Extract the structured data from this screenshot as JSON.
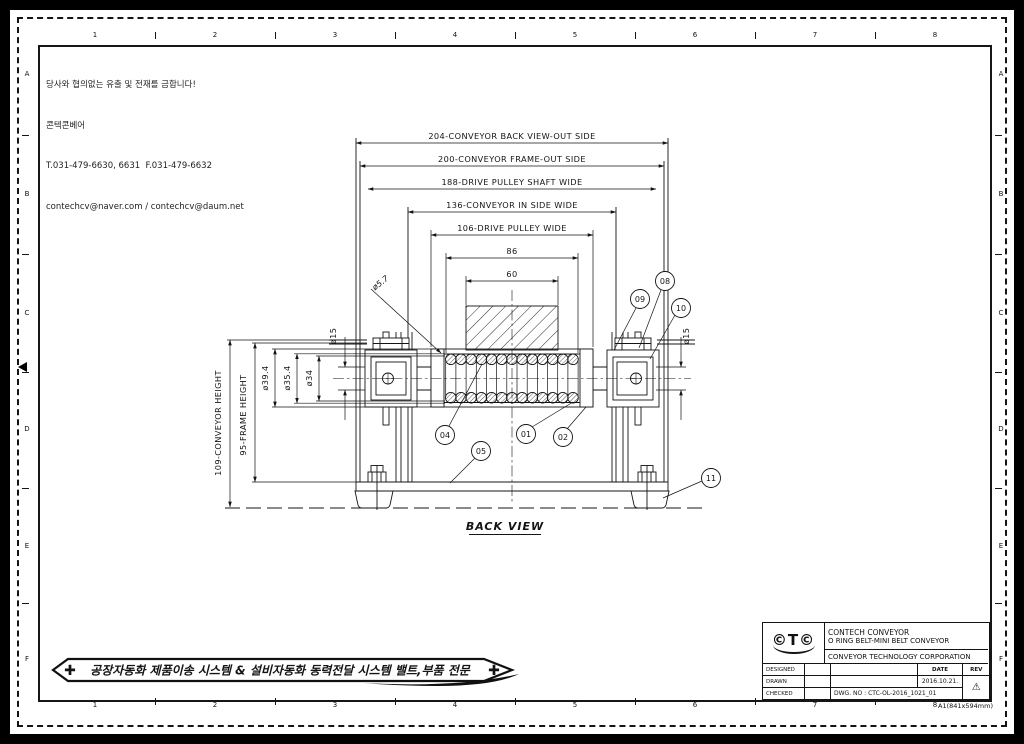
{
  "colors": {
    "line": "#141414",
    "paper": "#ffffff"
  },
  "notice": {
    "line1": "당사와 협의없는 유출 및 전재를 금합니다!",
    "line2": "콘텍콘베어",
    "line3": "T.031-479-6630, 6631  F.031-479-6632",
    "line4": "contechcv@naver.com / contechcv@daum.net"
  },
  "zones": {
    "cols": [
      "1",
      "2",
      "3",
      "4",
      "5",
      "6",
      "7",
      "8"
    ],
    "rows": [
      "A",
      "B",
      "C",
      "D",
      "E",
      "F"
    ]
  },
  "drawing": {
    "view_title": "BACK VIEW",
    "top_dims": [
      "204-CONVEYOR BACK VIEW-OUT SIDE",
      "200-CONVEYOR FRAME-OUT SIDE",
      "188-DRIVE PULLEY SHAFT WIDE",
      "136-CONVEYOR IN SIDE WIDE",
      "106-DRIVE PULLEY WIDE",
      "86",
      "60"
    ],
    "left_dims": [
      "109-CONVEYOR HEIGHT",
      "95-FRAME HEIGHT",
      "ø39.4",
      "ø35.4",
      "ø34"
    ],
    "dia_labels": {
      "oring": "ø5.7",
      "shaft_left": "ø15",
      "shaft_right": "ø15"
    },
    "balloons": {
      "b01": "01",
      "b02": "02",
      "b04": "04",
      "b05": "05",
      "b08": "08",
      "b09": "09",
      "b10": "10",
      "b11": "11"
    }
  },
  "banner": {
    "icon_left": "✚",
    "icon_right": "✚",
    "text": "공장자동화  제품이송  시스템  &  설비자동화  동력전달  시스템  밸트,부품  전문"
  },
  "title_block": {
    "logo": "©T©",
    "company_line1": "CONTECH CONVEYOR",
    "product": "O RING BELT-MINI BELT CONVEYOR",
    "company_line2": "CONVEYOR TECHNOLOGY CORPORATION",
    "labels": {
      "designed": "DESIGNED",
      "drawn": "DRAWN",
      "checked": "CHECKED",
      "date": "DATE",
      "rev": "REV"
    },
    "date_value": "2016.10.21.",
    "dwg_no": "DWG. NO : CTC-OL-2016_1021_01",
    "rev_symbol": "⚠"
  },
  "sheet_note": "A1(841x594mm)"
}
